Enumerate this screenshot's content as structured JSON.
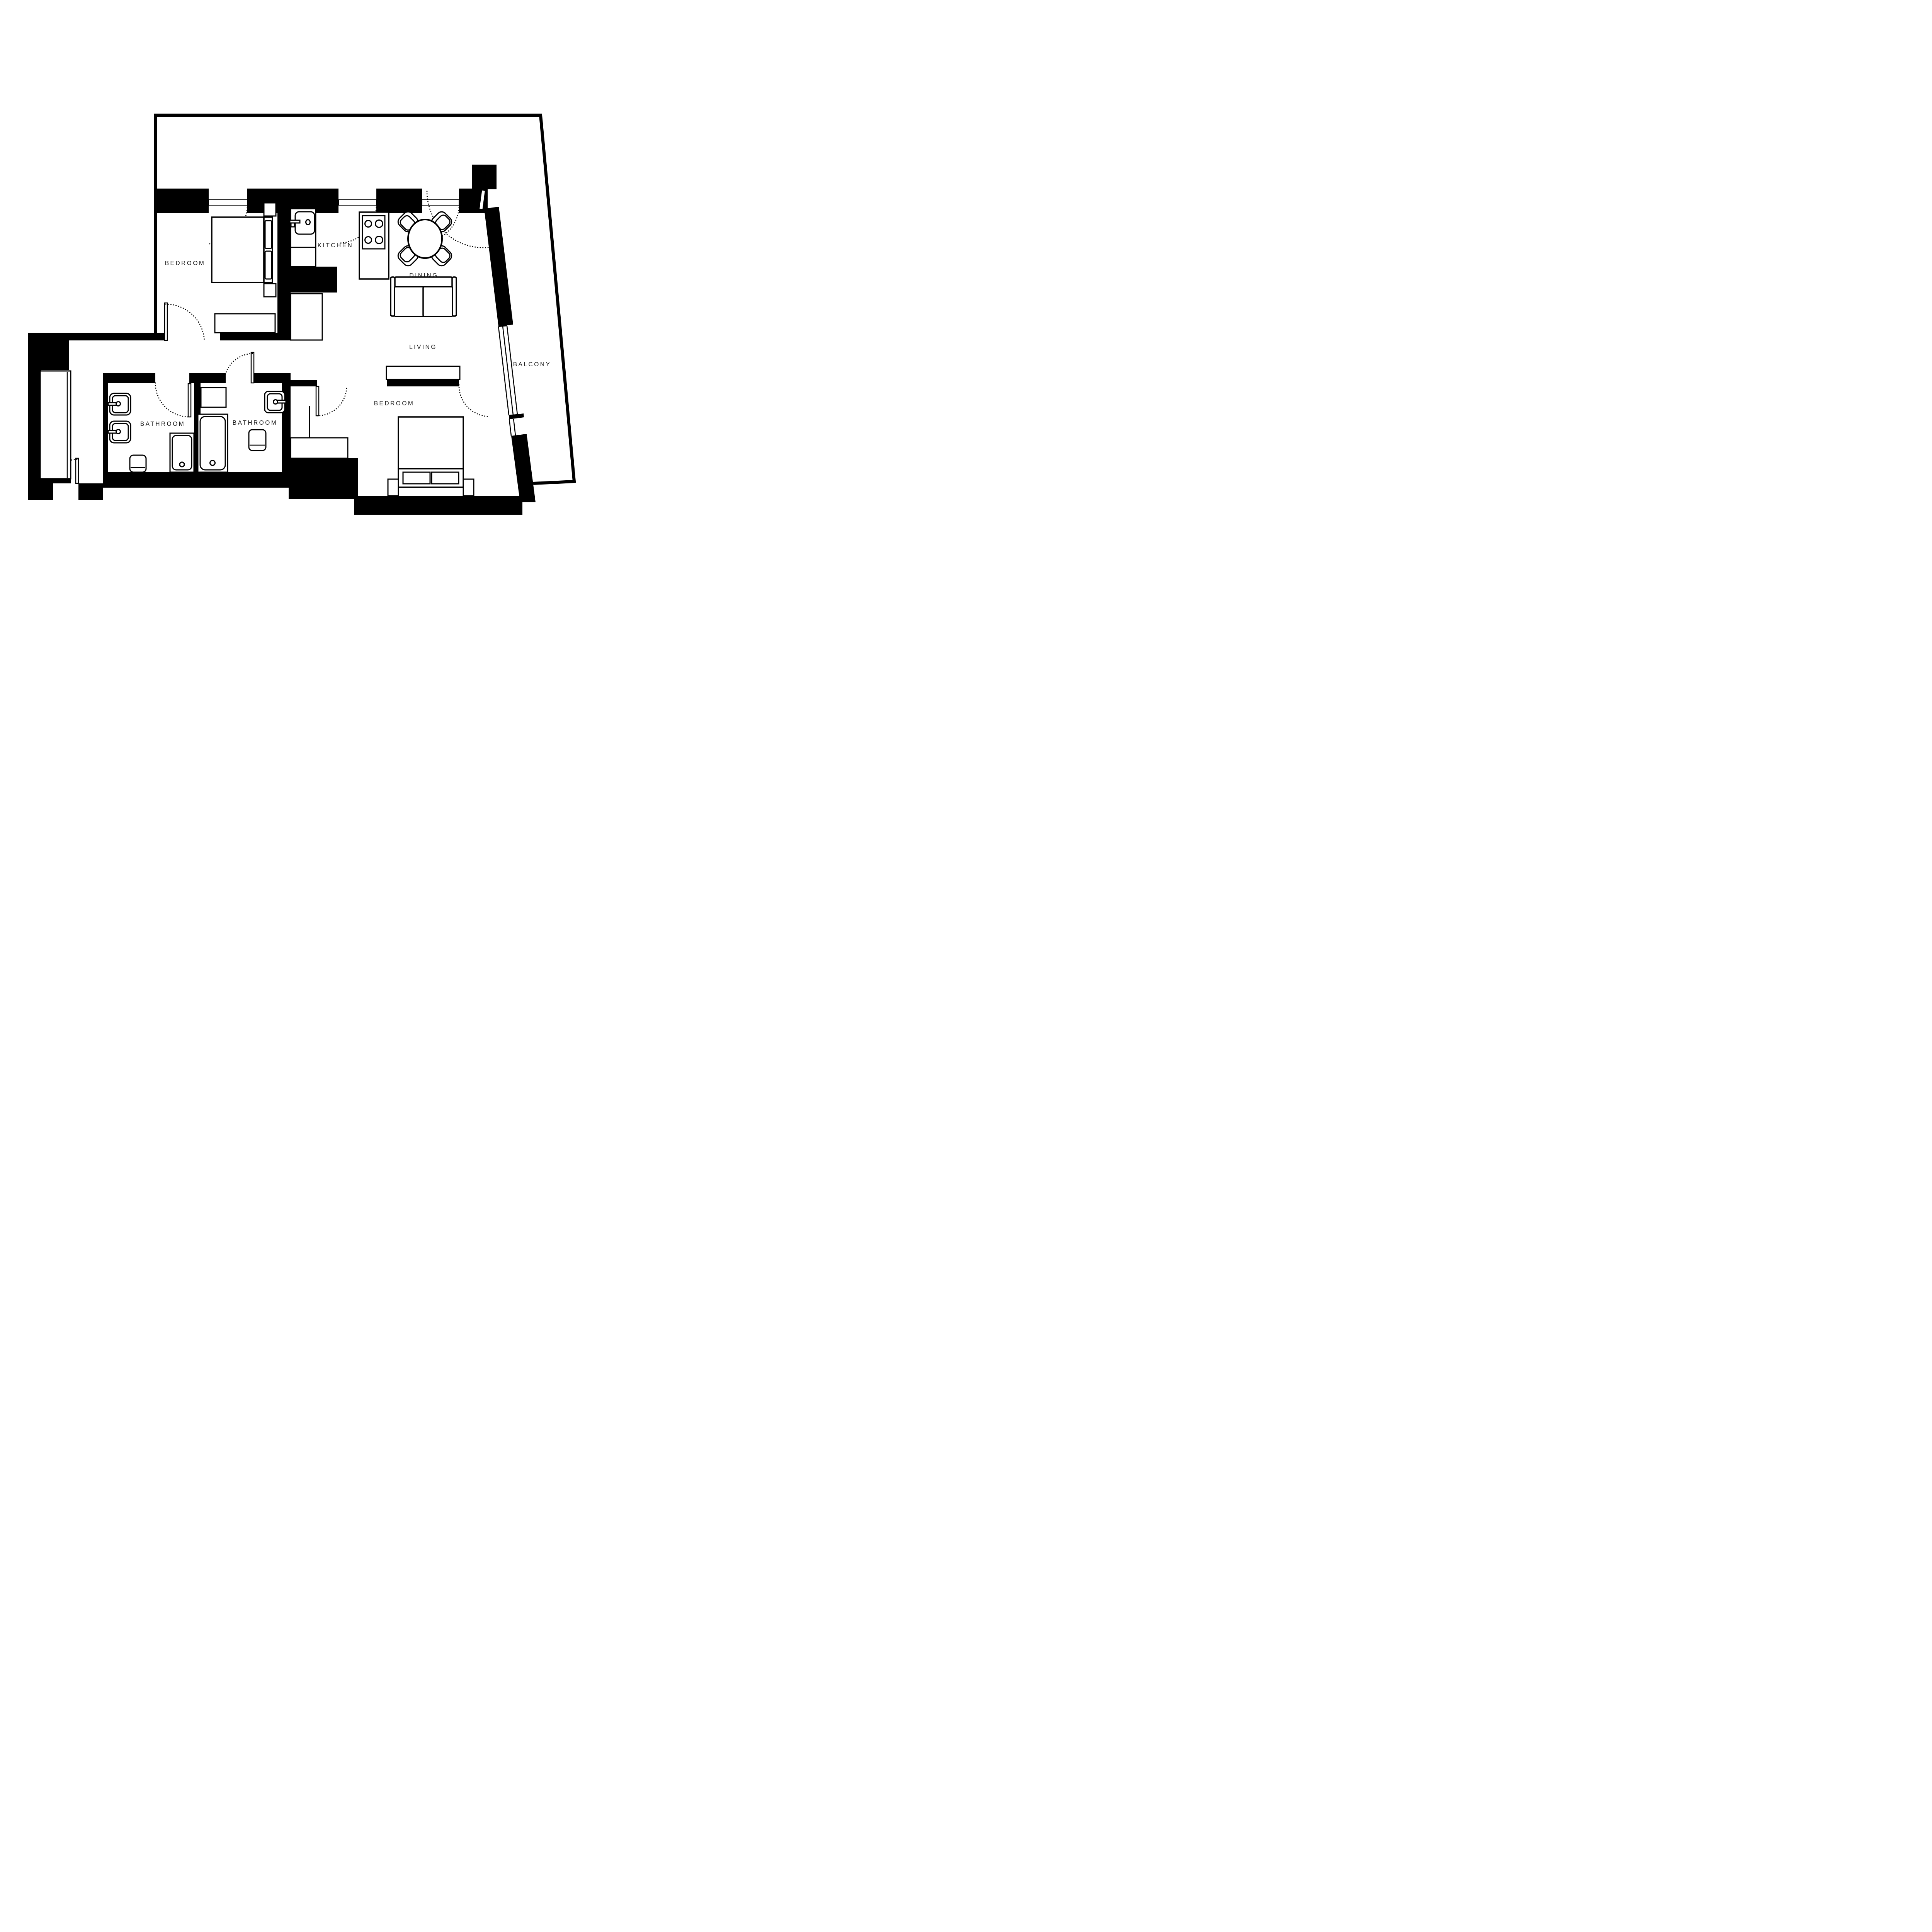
{
  "labels": {
    "bedroom_top": "BEDROOM",
    "kitchen": "KITCHEN",
    "dining": "DINING",
    "living": "LIVING",
    "balcony": "BALCONY",
    "bathroom_left": "BATHROOM",
    "bathroom_right": "BATHROOM",
    "bedroom_bottom": "BEDROOM"
  },
  "colors": {
    "wall": "#000000",
    "background": "#ffffff",
    "label_text": "#111111"
  }
}
